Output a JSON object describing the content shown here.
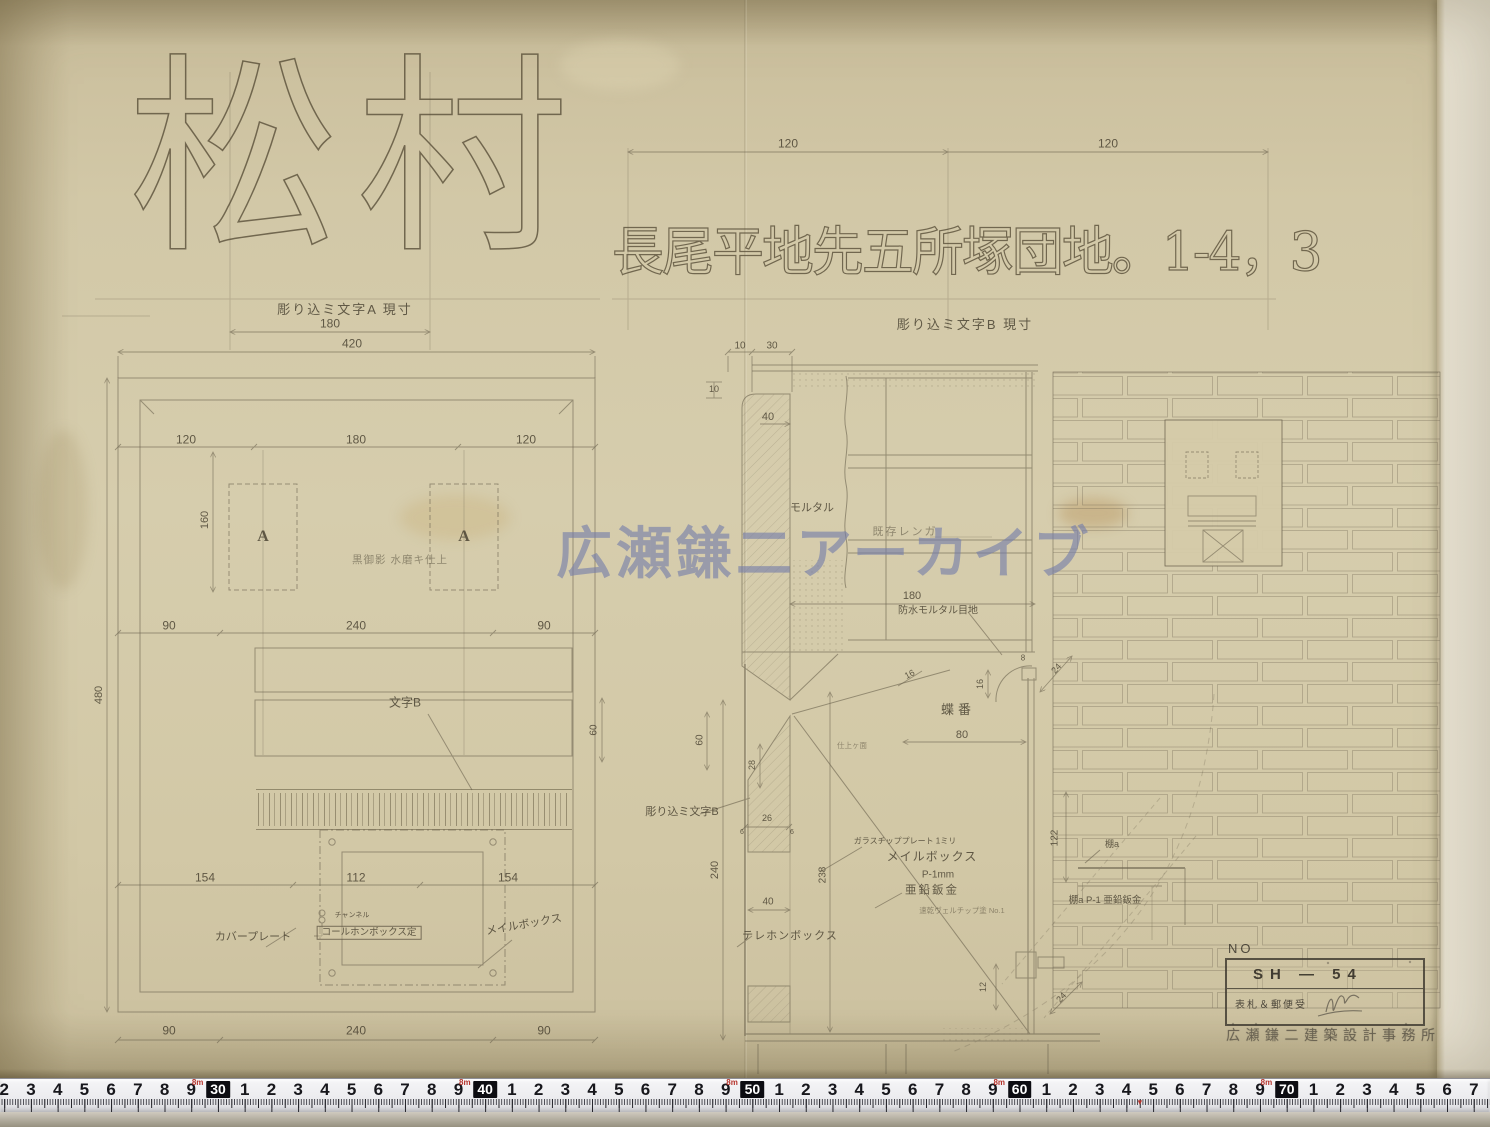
{
  "header": {
    "name_large": "松村",
    "caption_a": "彫り込ミ文字A 現寸",
    "dim_180": "180",
    "dim_120_left": "120",
    "dim_120_right": "120",
    "address_large": "長尾平地先五所塚団地。1-4，3",
    "caption_b": "彫り込ミ文字B 現寸"
  },
  "watermark": "広瀬鎌二アーカイブ",
  "plan": {
    "dim_420": "420",
    "top_dims": [
      "120",
      "180",
      "120"
    ],
    "dim_160": "160",
    "letter_a": "A",
    "finish_note": "黒御影 水磨キ仕上",
    "mid_dims": [
      "90",
      "240",
      "90"
    ],
    "dim_480": "480",
    "moji_b": "文字B",
    "dim_60": "60",
    "plate_dims": [
      "154",
      "112",
      "154"
    ],
    "channel_note": "チャンネル",
    "callbox_label": "コールホンボックス定",
    "cover_label": "カバープレート",
    "mailbox_label": "メイルボックス",
    "bottom_dims": [
      "90",
      "240",
      "90"
    ],
    "dim_240": "240",
    "engrave_b_label": "彫り込ミ文字B"
  },
  "section": {
    "dim_10_top": "10",
    "dim_30_top": "30",
    "dim_10_left": "10",
    "dim_40_col": "40",
    "mortar_label": "モルタル",
    "existing_label": "既存レンガ",
    "dim_180": "180",
    "waterproof_label": "防水モルタル目地",
    "finish_small": "仕上ヶ面",
    "hinge_label": "蝶番",
    "dim_80": "80",
    "dim_16_slope": "16",
    "dim_16_v": "16",
    "dim_8": "8",
    "dim_24_diag": "24",
    "dim_60": "60",
    "dim_28": "28",
    "dim_26": "26",
    "dim_6a": "6",
    "dim_6b": "6",
    "dim_238": "238",
    "dim_40_b": "40",
    "phone_label": "テレホンボックス",
    "plate_note": "ガラスチッププレート 1ミリ",
    "mailbox_label": "メイルボックス",
    "spec_p1": "P-1mm",
    "zinc_label": "亜鉛鈑金",
    "paint_note": "速乾ヴェルチップ塗 No.1",
    "dim_122": "122",
    "shelf_label": "棚a",
    "shelf_spec": "棚a P-1 亜鉛鈑金",
    "dim_12": "12",
    "dim_24_b": "24"
  },
  "title_block": {
    "no_label": "NO",
    "drawing_no": "SH — 54",
    "title": "表札＆郵便受",
    "office": "広瀬鎌二建築設計事務所"
  },
  "ruler": {
    "start_cm": 22,
    "end_cm": 77,
    "box_values": [
      30,
      40,
      50,
      60,
      70
    ],
    "meter_digit": "8",
    "unit": "m",
    "red_mark_cm": 64.5
  }
}
